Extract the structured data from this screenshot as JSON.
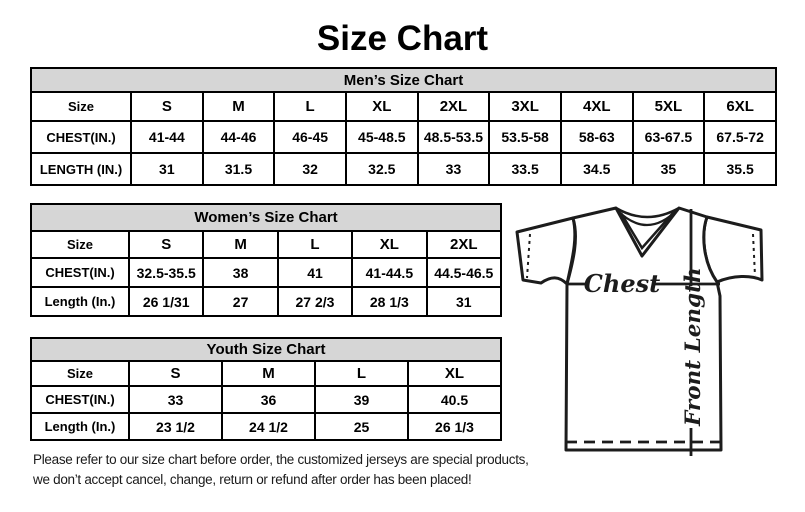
{
  "page": {
    "title": "Size Chart"
  },
  "colors": {
    "table_header_bg": "#d6d6d6",
    "border": "#000000",
    "text": "#000000"
  },
  "tables": {
    "men": {
      "title": "Men’s Size Chart",
      "header_row": [
        "Size",
        "S",
        "M",
        "L",
        "XL",
        "2XL",
        "3XL",
        "4XL",
        "5XL",
        "6XL"
      ],
      "rows": [
        [
          "CHEST(IN.)",
          "41-44",
          "44-46",
          "46-45",
          "45-48.5",
          "48.5-53.5",
          "53.5-58",
          "58-63",
          "63-67.5",
          "67.5-72"
        ],
        [
          "LENGTH (IN.)",
          "31",
          "31.5",
          "32",
          "32.5",
          "33",
          "33.5",
          "34.5",
          "35",
          "35.5"
        ]
      ]
    },
    "women": {
      "title": "Women’s Size Chart",
      "header_row": [
        "Size",
        "S",
        "M",
        "L",
        "XL",
        "2XL"
      ],
      "rows": [
        [
          "CHEST(IN.)",
          "32.5-35.5",
          "38",
          "41",
          "41-44.5",
          "44.5-46.5"
        ],
        [
          "Length (In.)",
          "26 1/31",
          "27",
          "27 2/3",
          "28 1/3",
          "31"
        ]
      ]
    },
    "youth": {
      "title": "Youth Size Chart",
      "header_row": [
        "Size",
        "S",
        "M",
        "L",
        "XL"
      ],
      "rows": [
        [
          "CHEST(IN.)",
          "33",
          "36",
          "39",
          "40.5"
        ],
        [
          "Length (In.)",
          "23 1/2",
          "24 1/2",
          "25",
          "26 1/3"
        ]
      ]
    }
  },
  "diagram": {
    "chest_label": "Chest",
    "front_length_label": "Front Length"
  },
  "footer": {
    "line1": "Please refer to our size chart before order, the customized jerseys are special products,",
    "line2": "we don’t accept cancel, change, return or refund after order has been placed!"
  }
}
